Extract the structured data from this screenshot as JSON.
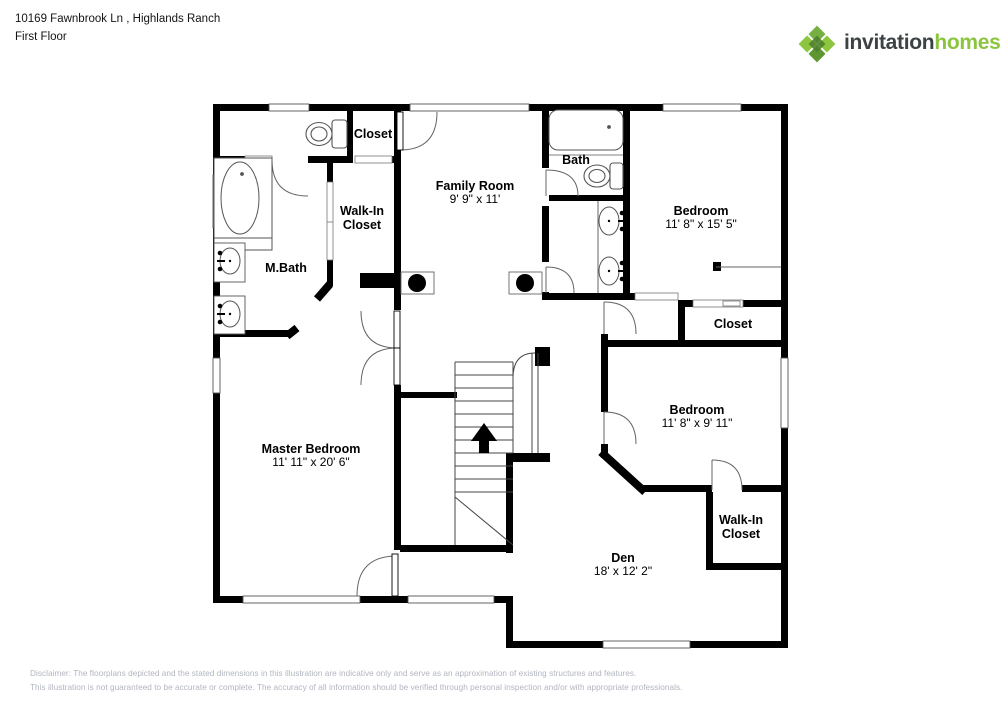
{
  "header": {
    "address": "10169 Fawnbrook Ln , Highlands Ranch",
    "floor_label": "First Floor"
  },
  "logo": {
    "brand_primary": "invitation",
    "brand_secondary": "homes",
    "trademark": "™"
  },
  "rooms": [
    {
      "name": "Family Room",
      "dims": "9' 9\" x 11'"
    },
    {
      "name": "Bath",
      "dims": ""
    },
    {
      "name": "Bedroom",
      "dims": "11' 8\" x 15' 5\""
    },
    {
      "name": "Closet",
      "dims": ""
    },
    {
      "name": "Walk-In Closet",
      "dims": ""
    },
    {
      "name": "M.Bath",
      "dims": ""
    },
    {
      "name": "Master Bedroom",
      "dims": "11' 11\" x 20' 6\""
    },
    {
      "name": "Closet",
      "dims": ""
    },
    {
      "name": "Bedroom",
      "dims": "11' 8\" x 9' 11\""
    },
    {
      "name": "Walk-In Closet",
      "dims": ""
    },
    {
      "name": "Den",
      "dims": "18' x 12' 2\""
    }
  ],
  "disclaimer": {
    "line1": "Disclaimer: The floorplans depicted and the stated dimensions in this illustration are indicative only and serve as an approximation of existing structures and features.",
    "line2": "This illustration is not guaranteed to be accurate or complete. The accuracy of all information should be verified through personal inspection and/or with appropriate professionals."
  },
  "colors": {
    "wall": "#000000",
    "fixture_line": "#555555",
    "logo_green_light": "#8cc63e",
    "logo_green_mid": "#76b043",
    "logo_green_dark": "#4d7f2a",
    "logo_text": "#3d4245",
    "disclaimer_text": "#b1b5c0"
  }
}
